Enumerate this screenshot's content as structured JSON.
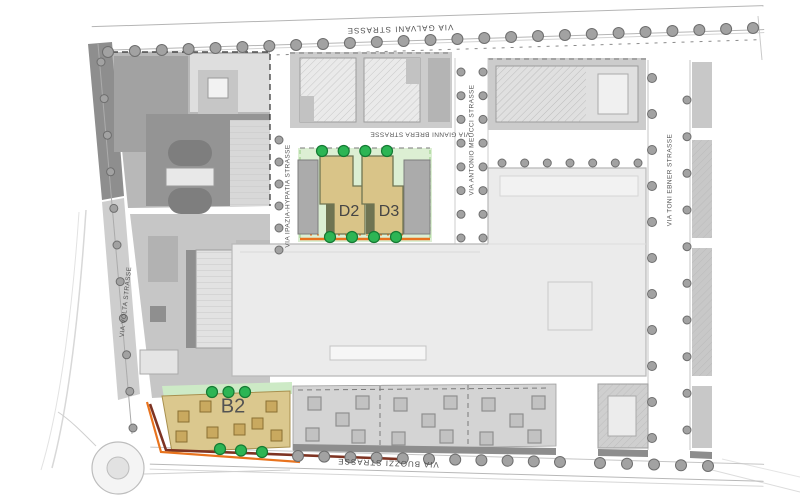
{
  "map": {
    "streets": {
      "galvani": {
        "label": "VIA GALVANI STRASSE"
      },
      "volta": {
        "label": "VIA VOLTA STRASSE"
      },
      "ipazia": {
        "label": "VIA IPAZIA-HYPATIA STRASSE"
      },
      "gianni_brera": {
        "label": "VIA GIANNI BRERA STRASSE"
      },
      "antonio_meucci": {
        "label": "VIA ANTONIO MEUCCI STRASSE"
      },
      "toni_ebner": {
        "label": "VIA TONI EBNER STRASSE"
      },
      "buozzi": {
        "label": "VIA BUOZZI STRASSE"
      }
    },
    "parcels": {
      "d2": {
        "label": "D2"
      },
      "d3": {
        "label": "D3"
      },
      "b2": {
        "label": "B2"
      }
    },
    "colors": {
      "parcel_fill": "#d9c488",
      "parcel_shadow": "#6f7452",
      "highlight_area_green": "#dcefd3",
      "tree_green": "#2db554",
      "accent_orange": "#e8731e",
      "accent_maroon": "#7e3322",
      "block_gray": "#c6c6c6",
      "building_light": "#ebebeb",
      "street_label_gray": "#4f4f4f"
    }
  }
}
